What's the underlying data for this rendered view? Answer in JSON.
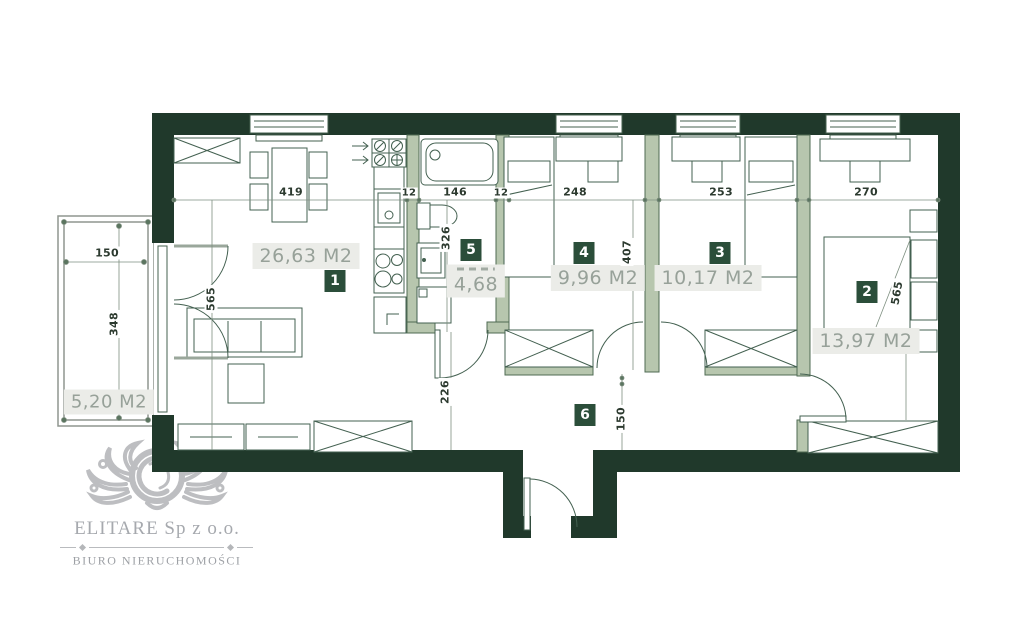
{
  "plan": {
    "rooms": [
      {
        "num": "1",
        "area": "26,63 M2",
        "name": "living-room-kitchen"
      },
      {
        "num": "2",
        "area": "13,97 M2",
        "name": "bedroom-main"
      },
      {
        "num": "3",
        "area": "10,17 M2",
        "name": "bedroom"
      },
      {
        "num": "4",
        "area": "9,96 M2",
        "name": "bedroom"
      },
      {
        "num": "5",
        "area": "4,68",
        "name": "bathroom"
      },
      {
        "num": "6",
        "area": "",
        "name": "hall"
      }
    ],
    "balcony": {
      "area": "5,20 M2"
    },
    "dimensions": {
      "living_width": "419",
      "wall_a": "12",
      "bath_width": "146",
      "wall_b": "12",
      "room4_width": "248",
      "room3_width": "253",
      "room2_width": "270",
      "living_depth": "565",
      "bath_depth": "326",
      "rooms_depth": "407",
      "bed_length": "565",
      "hall_depth": "226",
      "hall_width": "150",
      "balcony_width": "150",
      "balcony_depth": "348"
    }
  },
  "logo": {
    "company": "ELITARE Sp z o.o.",
    "tagline": "BIURO NIERUCHOMOŚCI"
  },
  "colors": {
    "wall": "#20392b",
    "partition": "#b7c6ae",
    "partition_edge": "#4f6b53",
    "furniture_line": "#436050",
    "badge_bg": "#2b4e3a",
    "badge_text": "#ffffff",
    "area_label_bg": "#ebece8",
    "area_label_text": "#97a199",
    "dim_text": "#2c3a2f",
    "logo_gray": "#bdbec1"
  }
}
